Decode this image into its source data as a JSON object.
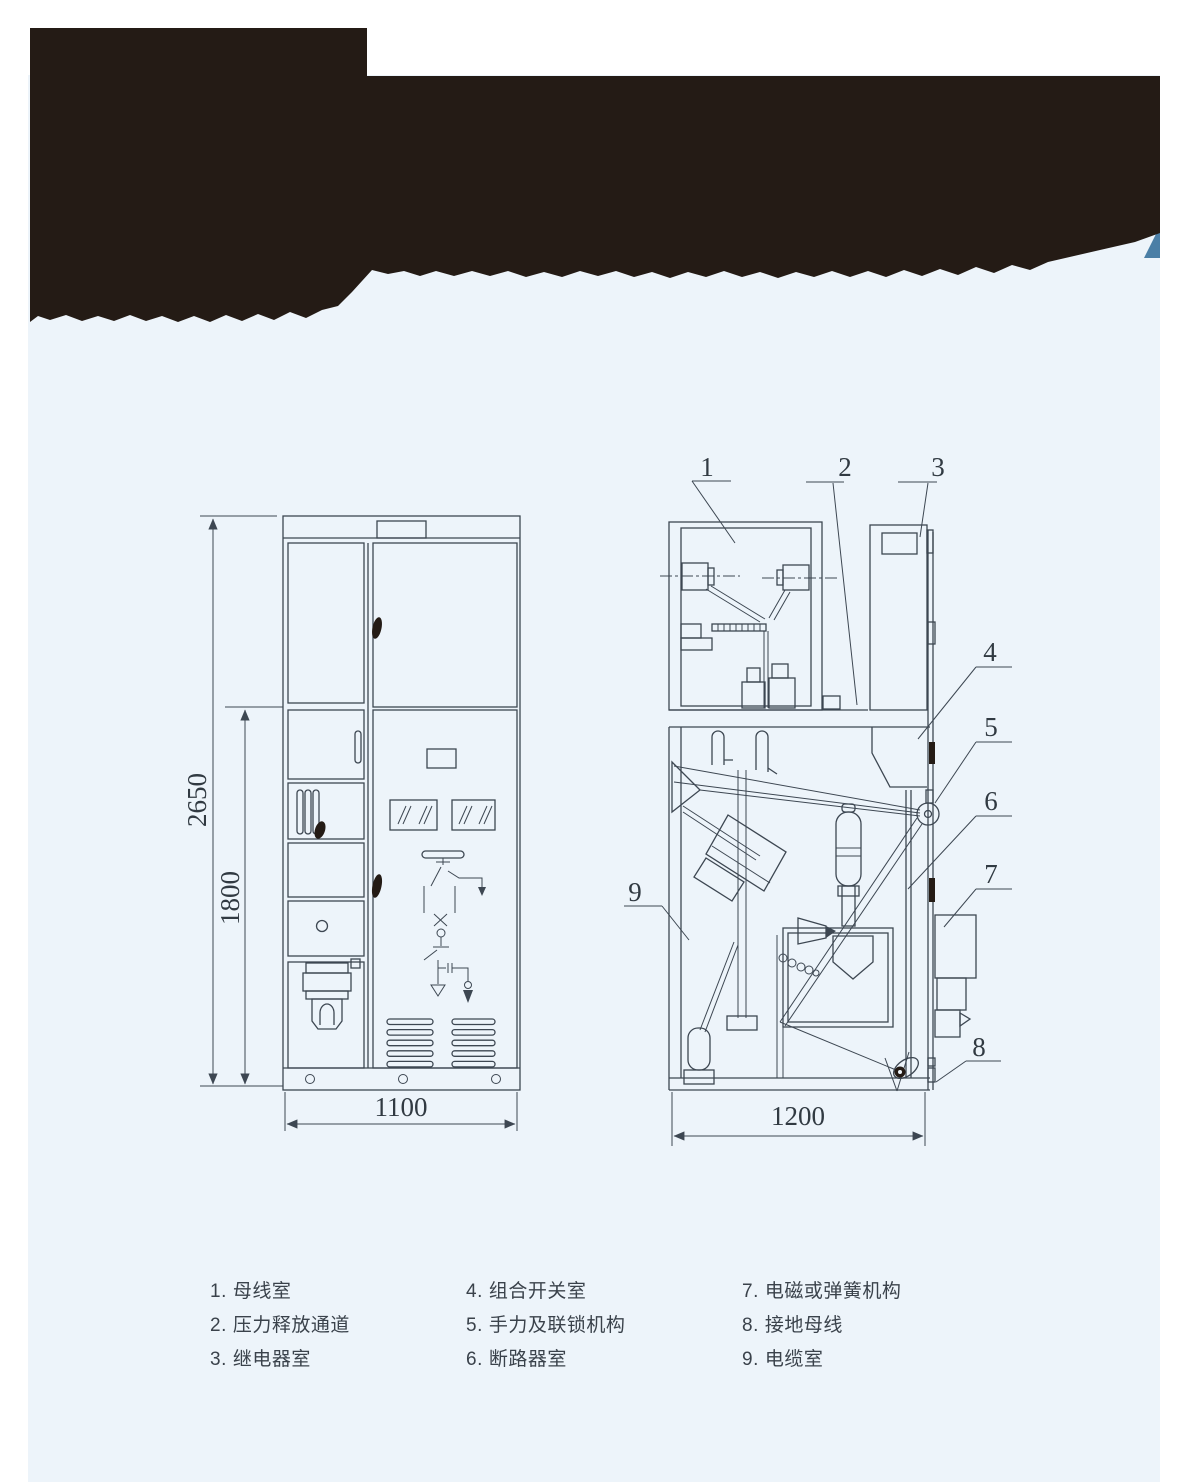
{
  "colors": {
    "panel_background": "#edf4fa",
    "banner_black": "#241b15",
    "banner_accent_blue": "#4b7fa6",
    "drawing_line": "#3d4752"
  },
  "front_view": {
    "dim_total_height": "2650",
    "dim_lower_height": "1800",
    "dim_width": "1100"
  },
  "side_view": {
    "dim_depth": "1200",
    "callouts": [
      "1",
      "2",
      "3",
      "4",
      "5",
      "6",
      "7",
      "8",
      "9"
    ]
  },
  "legend": {
    "items": [
      {
        "num": "1.",
        "text": "母线室"
      },
      {
        "num": "2.",
        "text": "压力释放通道"
      },
      {
        "num": "3.",
        "text": "继电器室"
      },
      {
        "num": "4.",
        "text": "组合开关室"
      },
      {
        "num": "5.",
        "text": "手力及联锁机构"
      },
      {
        "num": "6.",
        "text": "断路器室"
      },
      {
        "num": "7.",
        "text": "电磁或弹簧机构"
      },
      {
        "num": "8.",
        "text": "接地母线"
      },
      {
        "num": "9.",
        "text": "电缆室"
      }
    ]
  }
}
